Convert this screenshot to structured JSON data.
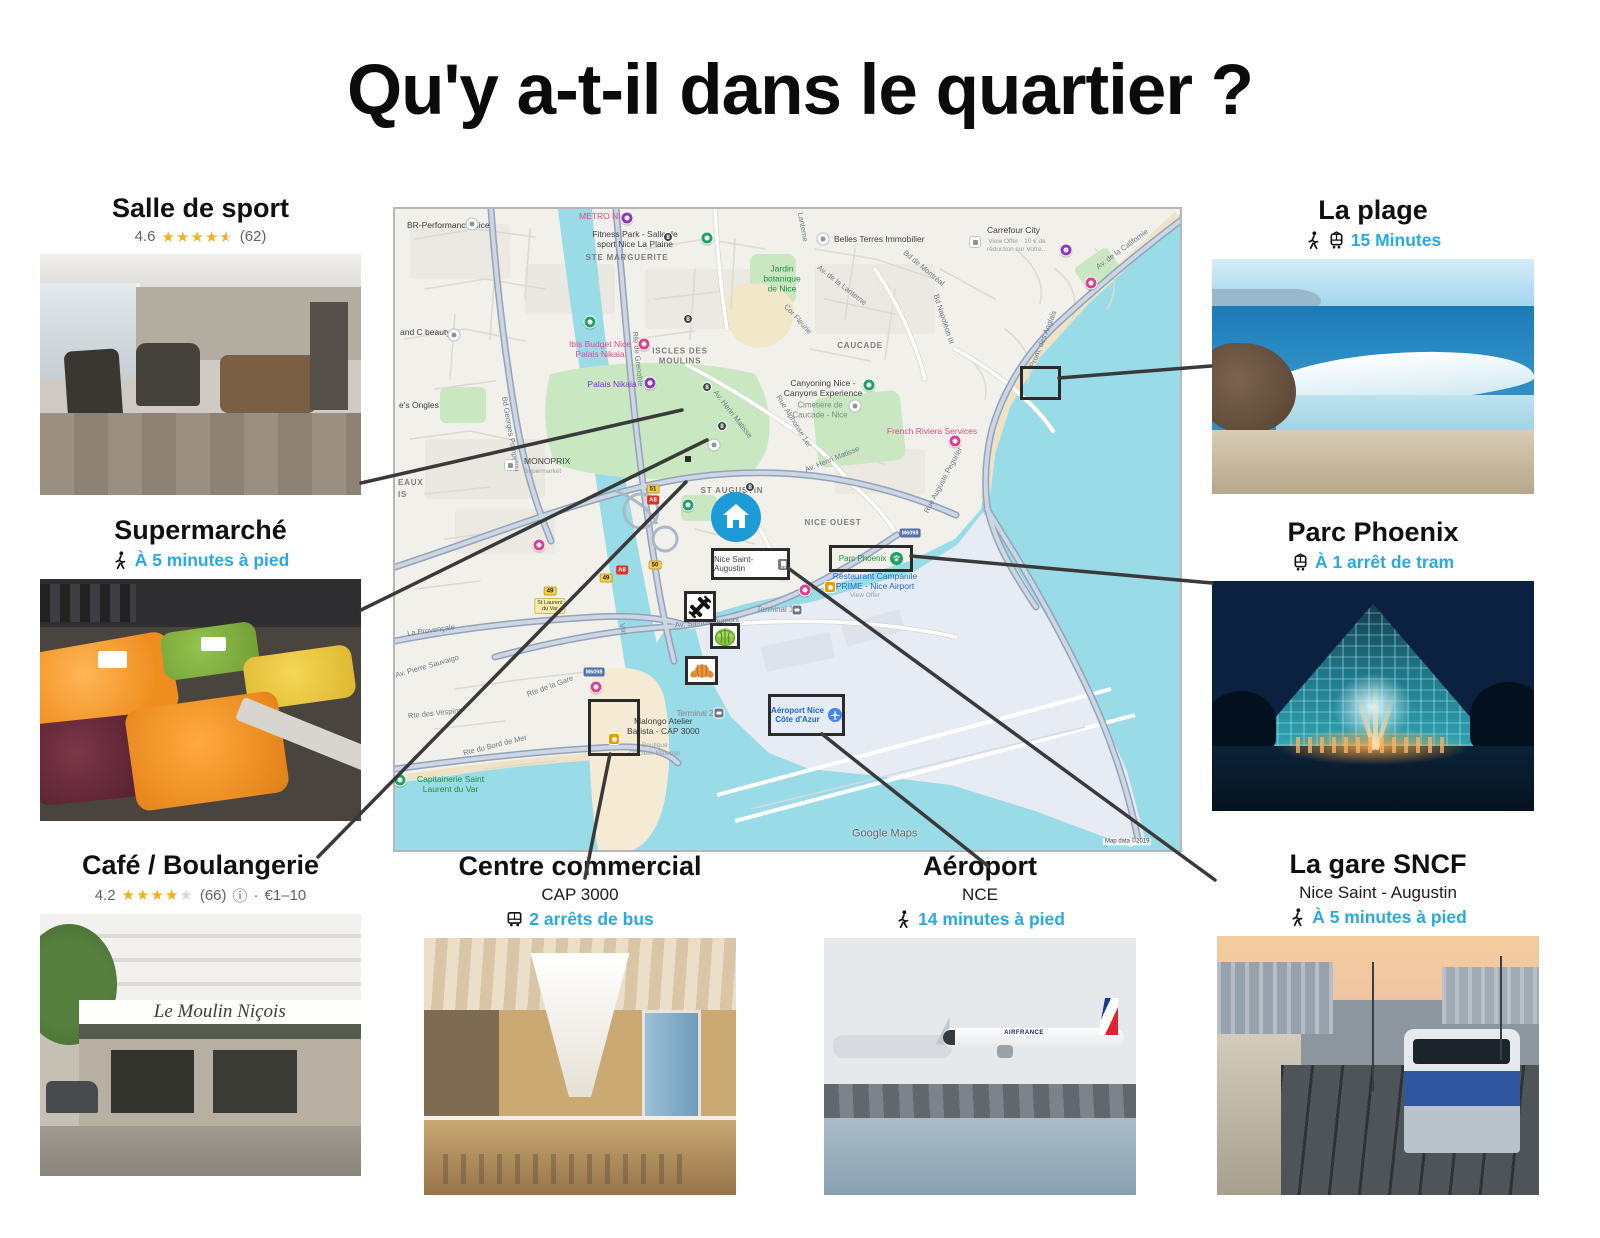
{
  "title": "Qu'y a-t-il dans le quartier ?",
  "colors": {
    "accent": "#29a9e1",
    "star": "#f2b01e",
    "star_empty": "#d8d8d8",
    "connector": "#3a3a3a"
  },
  "pois": {
    "gym": {
      "title": "Salle de sport",
      "rating_value": "4.6",
      "rating_stars": 4.5,
      "rating_count": "(62)"
    },
    "supermarket": {
      "title": "Supermarché",
      "transport": "À 5 minutes à pied",
      "transport_icons": [
        "walk-icon"
      ]
    },
    "cafe": {
      "title": "Café / Boulangerie",
      "rating_value": "4.2",
      "rating_stars": 4,
      "rating_count": "(66)",
      "info_icon": "ⓘ",
      "separator": "·",
      "price": "€1–10",
      "storefront_sign": "Le Moulin Niçois"
    },
    "mall": {
      "title": "Centre commercial",
      "subtitle": "CAP 3000",
      "transport": "2 arrêts de bus",
      "transport_icons": [
        "bus-icon"
      ]
    },
    "airport": {
      "title": "Aéroport",
      "subtitle": "NCE",
      "transport": "14 minutes à pied",
      "transport_icons": [
        "walk-icon"
      ],
      "plane_text": "AIRFRANCE"
    },
    "station": {
      "title": "La gare SNCF",
      "subtitle": "Nice Saint - Augustin",
      "transport": "À 5 minutes à pied",
      "transport_icons": [
        "walk-icon"
      ]
    },
    "beach": {
      "title": "La plage",
      "transport": "15 Minutes",
      "transport_icons": [
        "walk-icon",
        "tram-icon"
      ]
    },
    "park": {
      "title": "Parc Phoenix",
      "transport": "À 1 arrêt de tram",
      "transport_icons": [
        "tram-icon"
      ]
    }
  },
  "map": {
    "watermark": "Google Maps",
    "attribution": "Map data ©2019",
    "callouts": {
      "station": "Nice Saint-Augustin",
      "park": "Parc Phoenix",
      "airport": "Aéroport Nice\nCôte d'Azur"
    },
    "labels": [
      {
        "t": "BR-Performance Nice",
        "x": 12,
        "y": 16,
        "cls": "poi",
        "a": "l"
      },
      {
        "t": "METRO Nice",
        "x": 184,
        "y": 7,
        "cls": "pink",
        "a": "l"
      },
      {
        "t": "Fitness Park - Salle de\nsport Nice La Plaine",
        "x": 240,
        "y": 30,
        "cls": "poi"
      },
      {
        "t": "STE MARGUERITE",
        "x": 232,
        "y": 49,
        "cls": "area"
      },
      {
        "t": "Belles Terres Immobilier",
        "x": 439,
        "y": 30,
        "cls": "poi",
        "a": "l"
      },
      {
        "t": "Carrefour City",
        "x": 592,
        "y": 21,
        "cls": "poi",
        "a": "l"
      },
      {
        "t": "View Offer · 10 € de\nréduction sur Votre...",
        "x": 592,
        "y": 37,
        "cls": "tinytxt",
        "a": "l"
      },
      {
        "t": "Jardin\nbotanique\nde Nice",
        "x": 387,
        "y": 70,
        "cls": "green"
      },
      {
        "t": "and C beauty",
        "x": 5,
        "y": 123,
        "cls": "poi",
        "a": "l"
      },
      {
        "t": "Ibis Budget Nice\nPalais Nikaia",
        "x": 205,
        "y": 140,
        "cls": "pink"
      },
      {
        "t": "ISCLES DES\nMOULINS",
        "x": 285,
        "y": 147,
        "cls": "area"
      },
      {
        "t": "Palais Nikaia",
        "x": 217,
        "y": 175,
        "cls": "purple"
      },
      {
        "t": "CAUCADE",
        "x": 465,
        "y": 137,
        "cls": "area"
      },
      {
        "t": "Canyoning Nice -\nCanyons Experience",
        "x": 428,
        "y": 179,
        "cls": "poi"
      },
      {
        "t": "Cimetière de\nCaucade - Nice",
        "x": 425,
        "y": 201,
        "cls": "gray"
      },
      {
        "t": "French Riviera Services",
        "x": 537,
        "y": 222,
        "cls": "pink"
      },
      {
        "t": "MONOPRIX",
        "x": 129,
        "y": 252,
        "cls": "poi",
        "a": "l"
      },
      {
        "t": "Supermarket",
        "x": 129,
        "y": 263,
        "cls": "tinytxt",
        "a": "l"
      },
      {
        "t": "ST AUGUSTIN",
        "x": 337,
        "y": 282,
        "cls": "area"
      },
      {
        "t": "NICE OUEST",
        "x": 438,
        "y": 314,
        "cls": "area"
      },
      {
        "t": "Av. Henri Matisse",
        "x": 338,
        "y": 205,
        "cls": "road",
        "rot": 52
      },
      {
        "t": "Av. Henri Matisse",
        "x": 437,
        "y": 250,
        "cls": "road",
        "rot": -22
      },
      {
        "t": "Rue Alphonse 1er",
        "x": 399,
        "y": 212,
        "cls": "road",
        "rot": 58
      },
      {
        "t": "Bd Georges Pompidou",
        "x": 116,
        "y": 225,
        "cls": "road",
        "rot": 80
      },
      {
        "t": "Av. de la Lanterne",
        "x": 447,
        "y": 76,
        "cls": "road",
        "rot": 38
      },
      {
        "t": "Cor Fleurie",
        "x": 403,
        "y": 110,
        "cls": "road",
        "rot": 48
      },
      {
        "t": "Bd de Montréal",
        "x": 529,
        "y": 59,
        "cls": "road",
        "rot": 40
      },
      {
        "t": "Bd Napoléon III",
        "x": 549,
        "y": 110,
        "cls": "road",
        "rot": 72
      },
      {
        "t": "Av. de la Californie",
        "x": 727,
        "y": 40,
        "cls": "road",
        "rot": -36
      },
      {
        "t": "Prom. des Anglais",
        "x": 648,
        "y": 130,
        "cls": "road",
        "rot": -68
      },
      {
        "t": "Rue Auguste Pegurier",
        "x": 548,
        "y": 271,
        "cls": "road",
        "rot": -62
      },
      {
        "t": "Restaurant Campanile\nPRIME - Nice Airport",
        "x": 480,
        "y": 372,
        "cls": "blue"
      },
      {
        "t": "View Offer",
        "x": 470,
        "y": 387,
        "cls": "tinytxt"
      },
      {
        "t": "Av. Santos-Dumont",
        "x": 312,
        "y": 413,
        "cls": "road",
        "rot": -5
      },
      {
        "t": "Terminal 1",
        "x": 380,
        "y": 401,
        "cls": "gray"
      },
      {
        "t": "Terminal 2",
        "x": 300,
        "y": 505,
        "cls": "gray"
      },
      {
        "t": "Malongo Atelier\nBarista - CAP 3000",
        "x": 232,
        "y": 517,
        "cls": "poi",
        "a": "l"
      },
      {
        "t": "Boutique\nOfficielle Malongo",
        "x": 234,
        "y": 541,
        "cls": "tinytxt",
        "a": "l"
      },
      {
        "t": "Capitainerie Saint\nLaurent du Var",
        "x": 22,
        "y": 575,
        "cls": "green",
        "a": "l"
      },
      {
        "t": "Rte de la Gare",
        "x": 155,
        "y": 477,
        "cls": "road",
        "rot": -20
      },
      {
        "t": "La Provençale",
        "x": 36,
        "y": 421,
        "cls": "road",
        "rot": -8
      },
      {
        "t": "Av. Pierre Sauvaigo",
        "x": 32,
        "y": 457,
        "cls": "road",
        "rot": -16
      },
      {
        "t": "Rte des Vespins",
        "x": 40,
        "y": 504,
        "cls": "road",
        "rot": -6
      },
      {
        "t": "Rte du Bord de Mer",
        "x": 100,
        "y": 536,
        "cls": "road",
        "rot": -14
      },
      {
        "t": "Var",
        "x": 228,
        "y": 420,
        "cls": "water",
        "rot": 75
      },
      {
        "t": "Lanterne",
        "x": 408,
        "y": 18,
        "cls": "road",
        "rot": 80
      },
      {
        "t": "Rte de Grenoble",
        "x": 243,
        "y": 150,
        "cls": "road",
        "rot": 84
      },
      {
        "t": "EAUX",
        "x": 3,
        "y": 274,
        "cls": "area",
        "a": "l"
      },
      {
        "t": "IS",
        "x": 3,
        "y": 286,
        "cls": "area",
        "a": "l"
      },
      {
        "t": "e's Ongles",
        "x": 4,
        "y": 196,
        "cls": "poi",
        "a": "l"
      }
    ],
    "markers": [
      {
        "x": 77,
        "y": 15,
        "t": "wcirc"
      },
      {
        "x": 59,
        "y": 126,
        "t": "wcirc"
      },
      {
        "x": 428,
        "y": 30,
        "t": "wcirc"
      },
      {
        "x": 319,
        "y": 236,
        "t": "wcirc"
      },
      {
        "x": 460,
        "y": 197,
        "t": "wcirc"
      },
      {
        "x": 115,
        "y": 256,
        "t": "wsq"
      },
      {
        "x": 580,
        "y": 33,
        "t": "wsq"
      },
      {
        "x": 402,
        "y": 401,
        "t": "gsq"
      },
      {
        "x": 324,
        "y": 504,
        "t": "gsq"
      },
      {
        "x": 312,
        "y": 29,
        "t": "green"
      },
      {
        "x": 474,
        "y": 176,
        "t": "green"
      },
      {
        "x": 195,
        "y": 113,
        "t": "green"
      },
      {
        "x": 5,
        "y": 571,
        "t": "green"
      },
      {
        "x": 293,
        "y": 296,
        "t": "green"
      },
      {
        "x": 249,
        "y": 135,
        "t": "pink"
      },
      {
        "x": 560,
        "y": 232,
        "t": "pink"
      },
      {
        "x": 410,
        "y": 381,
        "t": "pink"
      },
      {
        "x": 201,
        "y": 478,
        "t": "pink"
      },
      {
        "x": 696,
        "y": 74,
        "t": "pink"
      },
      {
        "x": 144,
        "y": 336,
        "t": "pink"
      },
      {
        "x": 232,
        "y": 9,
        "t": "purple"
      },
      {
        "x": 255,
        "y": 174,
        "t": "purple"
      },
      {
        "x": 671,
        "y": 41,
        "t": "purple"
      },
      {
        "x": 273,
        "y": 28,
        "t": "stop8",
        "l": "8"
      },
      {
        "x": 293,
        "y": 110,
        "t": "stop8",
        "l": "8"
      },
      {
        "x": 312,
        "y": 178,
        "t": "stop8",
        "l": "8"
      },
      {
        "x": 327,
        "y": 217,
        "t": "stop8",
        "l": "8"
      },
      {
        "x": 355,
        "y": 278,
        "t": "stop8",
        "l": "8"
      },
      {
        "x": 219,
        "y": 530,
        "t": "osq"
      },
      {
        "x": 435,
        "y": 378,
        "t": "osq"
      },
      {
        "x": 258,
        "y": 280,
        "t": "sy",
        "l": "51"
      },
      {
        "x": 260,
        "y": 356,
        "t": "sy",
        "l": "50"
      },
      {
        "x": 211,
        "y": 369,
        "t": "sy",
        "l": "49"
      },
      {
        "x": 155,
        "y": 382,
        "t": "sy",
        "l": "49"
      },
      {
        "x": 258,
        "y": 291,
        "t": "sr",
        "l": "A8"
      },
      {
        "x": 227,
        "y": 361,
        "t": "sr",
        "l": "A8"
      },
      {
        "x": 325,
        "y": 364,
        "t": "sr",
        "l": "A8"
      },
      {
        "x": 515,
        "y": 324,
        "t": "sb",
        "l": "M6098"
      },
      {
        "x": 199,
        "y": 463,
        "t": "sb",
        "l": "M6098"
      },
      {
        "x": 155,
        "y": 397,
        "t": "ybox",
        "l": "St Laurent\ndu Var"
      }
    ]
  },
  "connectors": [
    [
      361,
      483,
      682,
      410
    ],
    [
      361,
      610,
      707,
      440
    ],
    [
      318,
      857,
      686,
      482
    ],
    [
      610,
      754,
      585,
      878
    ],
    [
      822,
      734,
      988,
      866
    ],
    [
      788,
      568,
      1215,
      880
    ],
    [
      911,
      556,
      1212,
      583
    ],
    [
      1059,
      378,
      1211,
      366
    ]
  ]
}
